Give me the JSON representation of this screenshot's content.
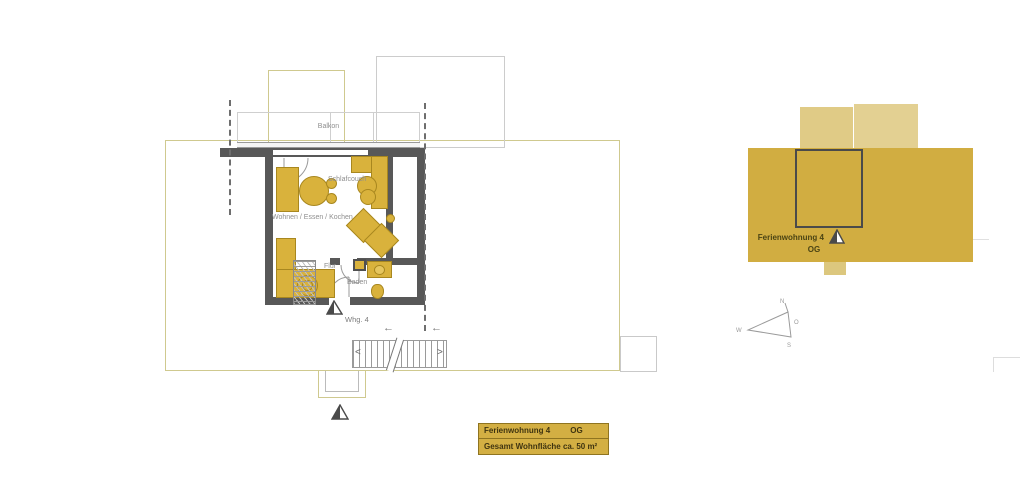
{
  "floorplan": {
    "balcony_label": "Balkon",
    "room_labels": {
      "schlafcouch": "Schlafcouch",
      "wohnen_essen_kochen": "Wohnen / Essen / Kochen",
      "flur": "Flur",
      "bad": "Baden"
    },
    "unit_marker_label": "Whg. 4"
  },
  "keyplan": {
    "name": "Ferienwohnung 4",
    "floor": "OG"
  },
  "compass": {
    "north": "N",
    "east": "O",
    "south": "S",
    "west": "W"
  },
  "legend": {
    "unit_name": "Ferienwohnung 4",
    "floor": "OG",
    "area_text": "Gesamt Wohnfläche ca. 50 m²"
  },
  "colors": {
    "furniture_gold": "#d9b23c",
    "furniture_border": "#a8871f",
    "keyplan_gold": "#d1ad41",
    "keyplan_light_gold": "#e0cb86",
    "legend_gold": "#d3af43",
    "wall_gray": "#585858",
    "outline_tan": "#cfc98f",
    "line_gray": "#b5b5b5",
    "label_gray": "#8f8f8f"
  }
}
